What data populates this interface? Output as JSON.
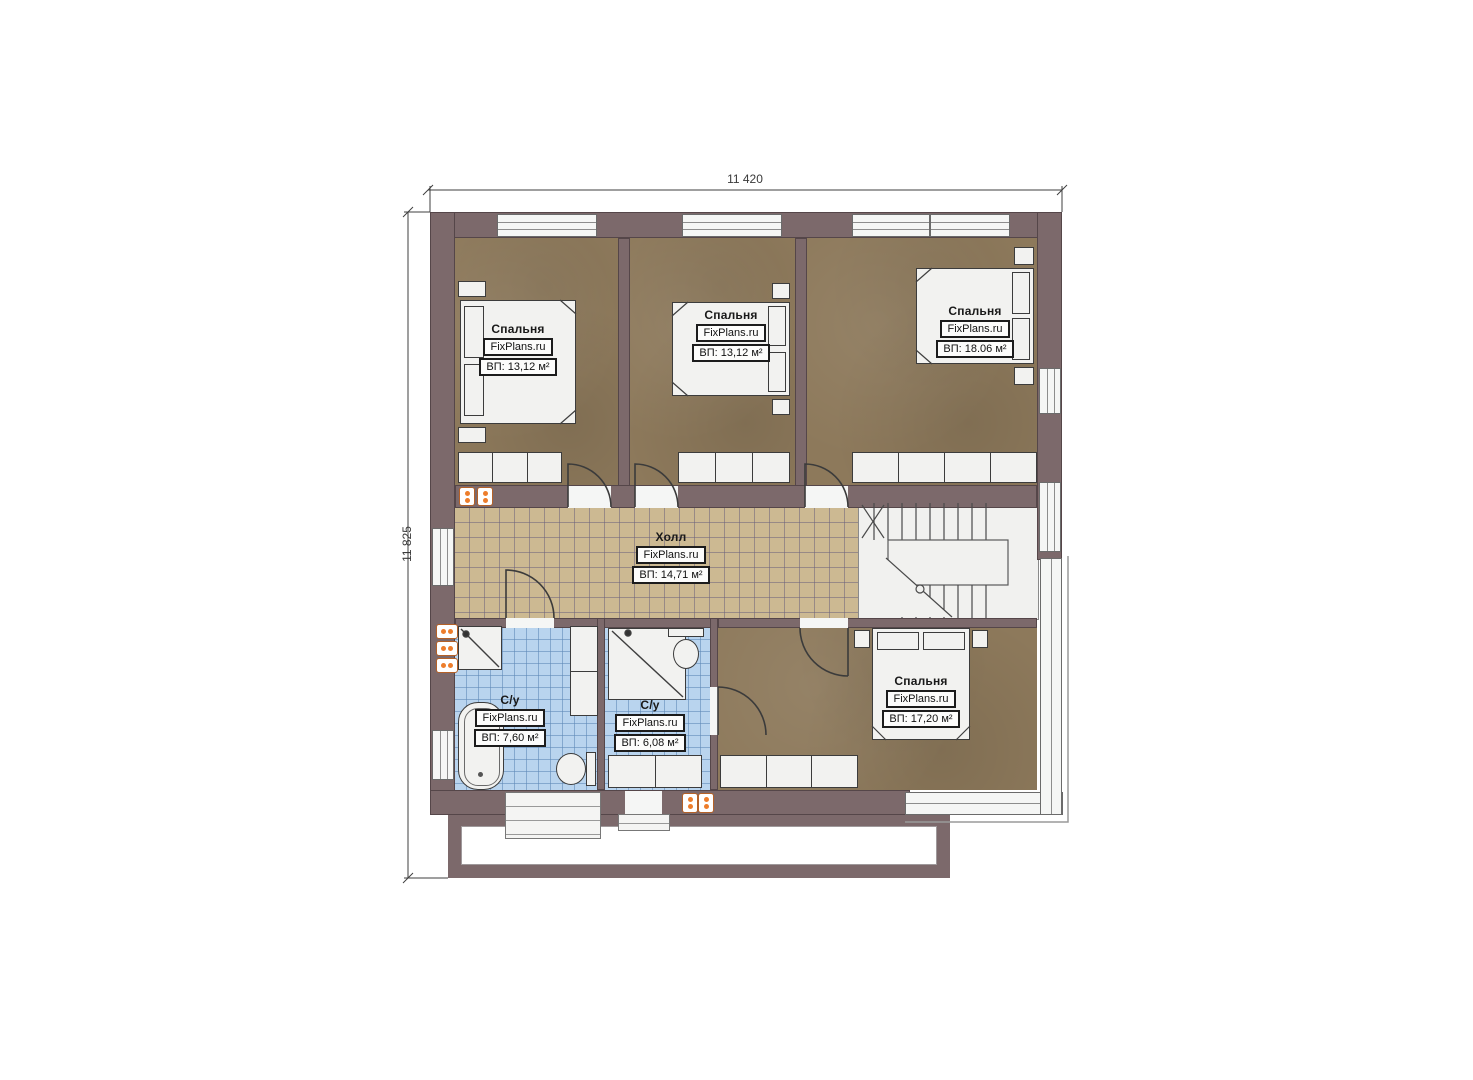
{
  "plan": {
    "title": "floor-plan-second-floor",
    "branding": "FixPlans.ru",
    "dimensions": {
      "top": "11 420",
      "left": "11 825"
    },
    "rooms": [
      {
        "id": "bedroom-1",
        "name": "Спальня",
        "area": "ВП: 13,12 м²"
      },
      {
        "id": "bedroom-2",
        "name": "Спальня",
        "area": "ВП: 13,12 м²"
      },
      {
        "id": "bedroom-3",
        "name": "Спальня",
        "area": "ВП: 18.06 м²"
      },
      {
        "id": "hall",
        "name": "Холл",
        "area": "ВП: 14,71 м²"
      },
      {
        "id": "bathroom-1",
        "name": "С/у",
        "area": "ВП: 7,60 м²"
      },
      {
        "id": "bathroom-2",
        "name": "С/у",
        "area": "ВП: 6,08 м²"
      },
      {
        "id": "bedroom-4",
        "name": "Спальня",
        "area": "ВП: 17,20 м²"
      }
    ],
    "colors": {
      "wall": "#7c696b",
      "bedroom_floor": "#8d795b",
      "hall_tile": "#ccb992",
      "bath_tile": "#b9d4ee",
      "fixture": "#f2f2f0",
      "radiator": "#ed7d2b"
    }
  }
}
